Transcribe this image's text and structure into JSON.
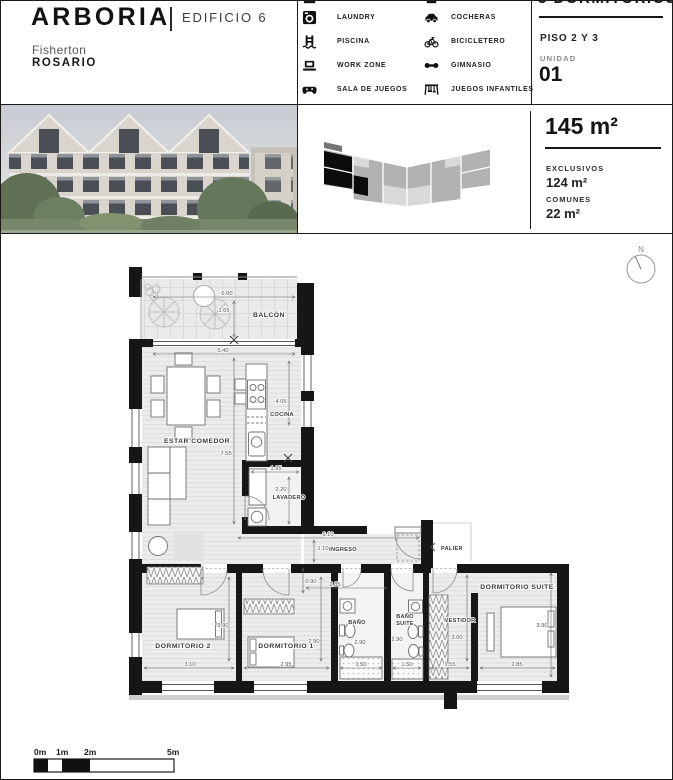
{
  "header": {
    "brand": "ARBORIA",
    "building": "EDIFICIO 6",
    "neighborhood": "Fisherton",
    "city": "ROSARIO"
  },
  "amenities": {
    "col1": [
      {
        "label": "LAUNDRY",
        "icon": "washing-machine-icon"
      },
      {
        "label": "PISCINA",
        "icon": "pool-ladder-icon"
      },
      {
        "label": "WORK ZONE",
        "icon": "laptop-icon"
      },
      {
        "label": "SALA DE JUEGOS",
        "icon": "game-controller-icon"
      }
    ],
    "col2": [
      {
        "label": "COCHERAS",
        "icon": "car-icon"
      },
      {
        "label": "BICICLETERO",
        "icon": "bicycle-icon"
      },
      {
        "label": "GIMNASIO",
        "icon": "dumbbell-icon"
      },
      {
        "label": "JUEGOS INFANTILES",
        "icon": "playground-icon"
      }
    ]
  },
  "unit_panel": {
    "title": "3 DORMITORIOS",
    "floor": "PISO 2 Y 3",
    "unit_label": "UNIDAD",
    "unit_number": "01"
  },
  "area_panel": {
    "total": "145 m²",
    "exclusivos_label": "EXCLUSIVOS",
    "exclusivos_value": "124 m²",
    "comunes_label": "COMUNES",
    "comunes_value": "22 m²"
  },
  "plan": {
    "compass": "N",
    "labels": {
      "balcon": "BALCÓN",
      "estar": "ESTAR COMEDOR",
      "cocina": "COCINA",
      "lavadero": "LAVADERO",
      "ingreso": "INGRESO",
      "palier": "PALIER",
      "dorm2": "DORMITORIO 2",
      "dorm1": "DORMITORIO 1",
      "bano": "BAÑO",
      "bano_suite_1": "BAÑO",
      "bano_suite_2": "SUITE",
      "vestidor": "VESTIDOR",
      "suite": "DORMITORIO SUITE"
    },
    "dims": {
      "balcon_w": "6.00",
      "balcon_d": "1.65",
      "estar_w": "5.40",
      "estar_l": "7.55",
      "cocina_l": "4.05",
      "lavadero_w": "1.95",
      "lavadero_l": "2.20",
      "ingreso_l": "6.10",
      "ingreso_w": "1.10",
      "pasillo_w": "0.90",
      "hall_w": "2.85",
      "dorm2_l": "3.90",
      "dorm2_w": "3.10",
      "dorm1_l": "2.90",
      "dorm1_w": "2.95",
      "bano_l": "2.90",
      "bano_w": "1.50",
      "banosuite_l": "2.90",
      "banosuite_w": "1.50",
      "vestidor_l": "3.00",
      "vestidor_w": "1.55",
      "suite_l": "3.90",
      "suite_w": "2.85"
    }
  },
  "scalebar": {
    "labels": [
      "0m",
      "1m",
      "2m",
      "5m"
    ]
  },
  "colors": {
    "wall": "#161616",
    "text": "#1a1a1a"
  }
}
